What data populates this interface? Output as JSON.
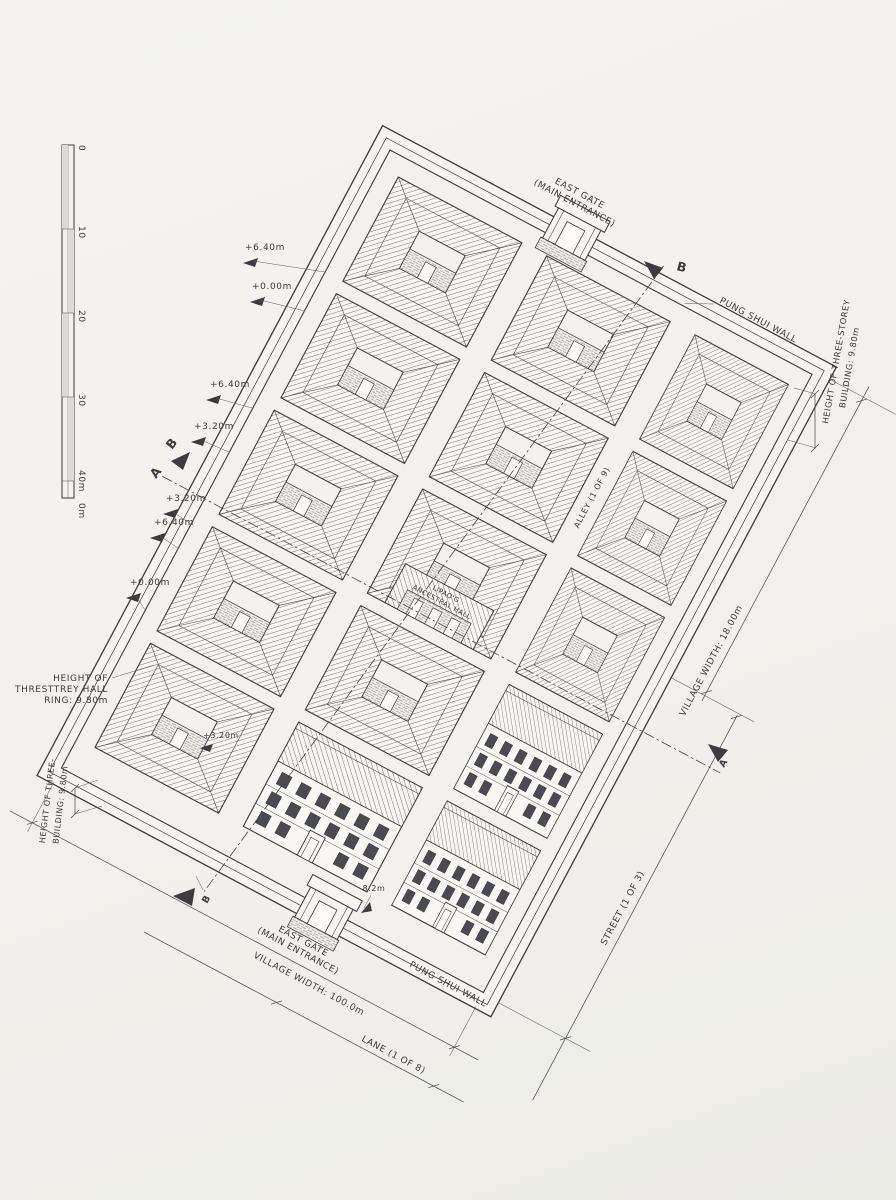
{
  "colors": {
    "paper": "#f2f0ec",
    "ink": "#3b3b41"
  },
  "scale_bar": {
    "ticks": [
      "0",
      "10",
      "20",
      "30",
      "40m"
    ],
    "origin": "0m"
  },
  "top_gate": {
    "line1": "EAST GATE",
    "line2": "(MAIN ENTRANCE)"
  },
  "bottom_gate": {
    "line1": "EAST GATE",
    "line2": "(MAIN ENTRANCE)"
  },
  "feng_shui_wall": {
    "top": "PUNG SHUI WALL",
    "bottom": "PUNG SHUI WALL"
  },
  "sections": {
    "b_top": "B",
    "b_left": "B",
    "a_left": "A",
    "a_right": "A",
    "b_bottom": "B"
  },
  "elevations": {
    "e1": "+6.40m",
    "e2": "+0.00m",
    "e3": "+6.40m",
    "e4": "+3.20m",
    "e5": "+3.20m",
    "e6": "+6.40m",
    "e7": "+0.00m",
    "e8": "+3.20m"
  },
  "dimensions": {
    "village_width_bottom": "VILLAGE WIDTH: 100.0m",
    "lane": "LANE (1 OF 8)",
    "village_width_right": "VILLAGE WIDTH: 18.00m",
    "street": "STREET (1 OF 3)",
    "alley": "ALLEY (1 OF 9)",
    "gate_width": "8.2m"
  },
  "height_notes": {
    "hall_1": "HEIGHT OF",
    "hall_2": "THRESTTREY HALL",
    "hall_3": "RING: 9.80m",
    "left_1": "HEIGHT OF THREE-",
    "left_2": "BUILDING: 9.80m",
    "right_1": "HEIGHT OF THREE-STOREY",
    "right_2": "BUILDING: 9.80m"
  },
  "hall": {
    "line1": "LIPAO'G",
    "line2": "ANCESTRAL HALL"
  }
}
